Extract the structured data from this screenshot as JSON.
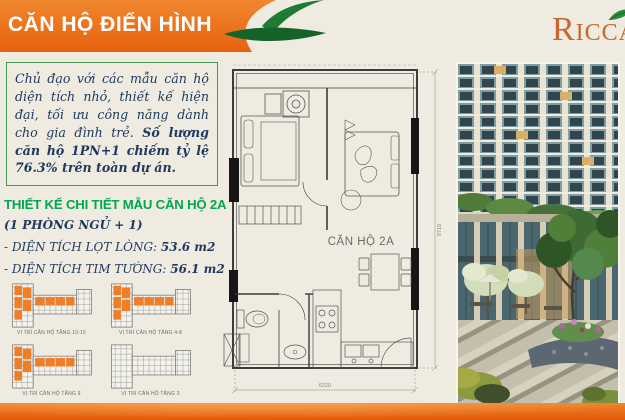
{
  "slide": {
    "banner": {
      "title": "CĂN HỘ ĐIỂN HÌNH"
    },
    "logo": {
      "brand": "Ricca"
    },
    "intro": {
      "normal": "Chủ đạo với các mẫu căn hộ diện tích nhỏ, thiết kế hiện đại, tối ưu công năng dành cho gia đình trẻ. ",
      "bold": "Số lượng căn hộ 1PN+1 chiếm tỷ lệ 76.3% trên toàn dự án."
    },
    "details": {
      "heading": "THIẾT KẾ CHI TIẾT MẪU CĂN HỘ 2A",
      "subheading": "(1 PHÒNG NGỦ + 1)",
      "areas": [
        {
          "label": "- DIỆN TÍCH LỌT LÒNG: ",
          "value": "53.6 m2"
        },
        {
          "label": "- DIỆN TÍCH TIM TƯỜNG: ",
          "value": "56.1 m2"
        }
      ]
    },
    "mini_plans": [
      {
        "caption": "VỊ TRÍ CĂN HỘ TẦNG 10-15",
        "highlighted": true
      },
      {
        "caption": "VỊ TRÍ CĂN HỘ TẦNG 4-8",
        "highlighted": true
      },
      {
        "caption": "VỊ TRÍ CĂN HỘ TẦNG 9",
        "highlighted": true
      },
      {
        "caption": "VỊ TRÍ CĂN HỘ TẦNG 3",
        "highlighted": false
      }
    ],
    "floor_plan": {
      "unit_label": "CĂN HỘ 2A",
      "width_dim": "6220",
      "height_dim": "9710"
    },
    "colors": {
      "accent_orange": "#E8701A",
      "accent_green": "#00A651",
      "leaf_green": "#1B7A33",
      "navy": "#1E3A5F"
    }
  }
}
